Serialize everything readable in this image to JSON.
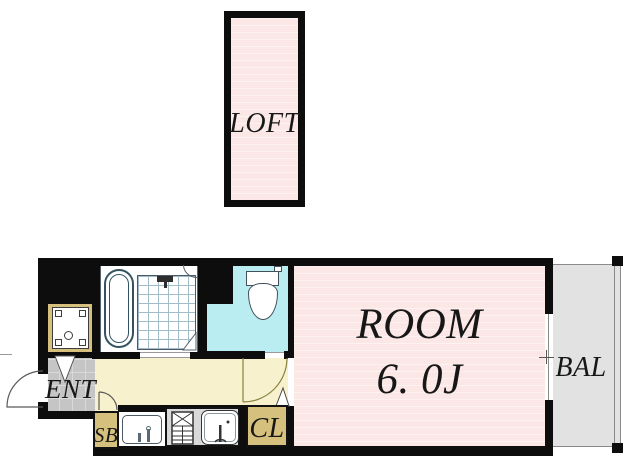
{
  "plan_title": "studio apartment floor plan",
  "labels": {
    "loft": "LOFT",
    "entrance": "ENT",
    "shoe_box": "SB",
    "closet": "CL",
    "room_name": "ROOM",
    "room_size": "6. 0J",
    "balcony": "BAL"
  },
  "colors": {
    "wall": "#0d0d0d",
    "room_pink": "#fbe7e5",
    "room_pink_stripe": "#fdf2f0",
    "toilet_cyan": "#b9edf2",
    "hallway_cream": "#f8f1cd",
    "tan": "#d5c07e",
    "entrance_gray": "#c5c5c5",
    "kitchen_gray": "#d9d9d9",
    "balcony_gray": "#e2e2e2"
  }
}
